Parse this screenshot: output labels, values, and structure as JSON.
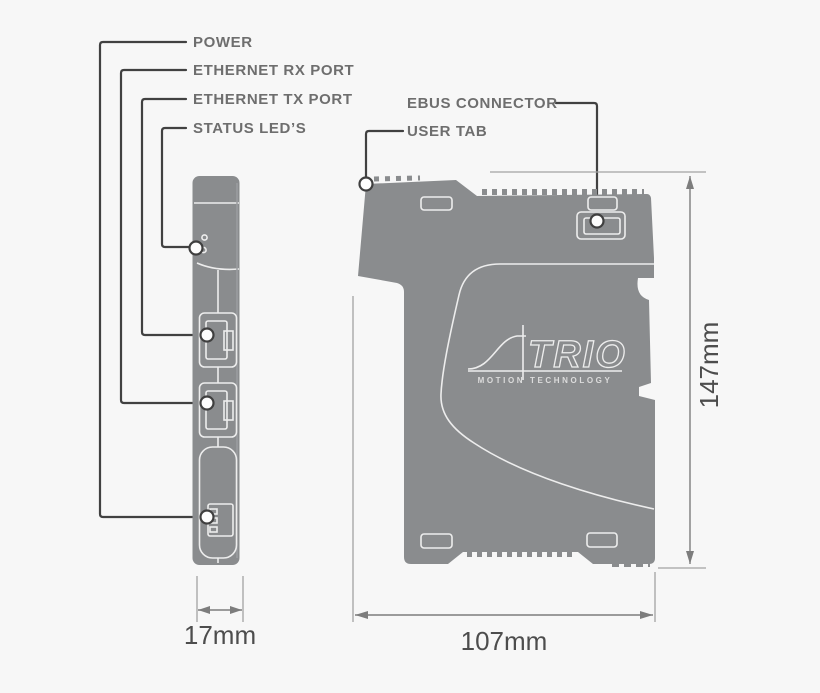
{
  "colors": {
    "background": "#f7f7f7",
    "device_gray": "#8a8c8e",
    "device_line": "#ededed",
    "leader_line": "#414141",
    "label_text": "#6e6e6e",
    "dimension_text": "#4d4d4d"
  },
  "callouts": {
    "power": {
      "label": "POWER"
    },
    "ethernet_rx": {
      "label": "ETHERNET RX PORT"
    },
    "ethernet_tx": {
      "label": "ETHERNET TX PORT"
    },
    "status_leds": {
      "label": "STATUS LED’S"
    },
    "ebus": {
      "label": "EBUS CONNECTOR"
    },
    "user_tab": {
      "label": "USER TAB"
    }
  },
  "dimensions": {
    "side_width": "17mm",
    "front_width": "107mm",
    "front_height": "147mm"
  },
  "logo": {
    "name": "TRIO",
    "tagline": "MOTION TECHNOLOGY"
  }
}
